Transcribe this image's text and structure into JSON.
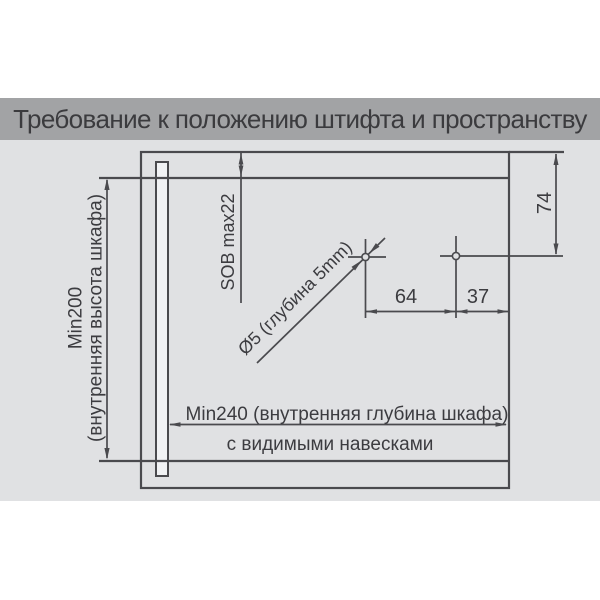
{
  "title": "Требование к положению штифта и пространству",
  "diagram": {
    "height_dim_line1": "Min200",
    "height_dim_line2": "(внутренняя высота шкафа)",
    "top_clearance_dim": "SOB max22",
    "hole_spec": "Ø5 (глубина 5mm)",
    "dim_pin_to_pin": "64",
    "dim_pin_to_back": "37",
    "dim_top_to_pin": "74",
    "depth_dim": "Min240 (внутренняя глубина шкафа)",
    "hinge_note": "с видимыми навесками"
  },
  "colors": {
    "title_bar_bg": "#a2a3a5",
    "title_text": "#3b3b3e",
    "panel_bg": "#e0e1e3",
    "line": "#4a4a4e",
    "dim_text": "#3c3c40",
    "side_bar_fill": "#f1f2f4"
  }
}
